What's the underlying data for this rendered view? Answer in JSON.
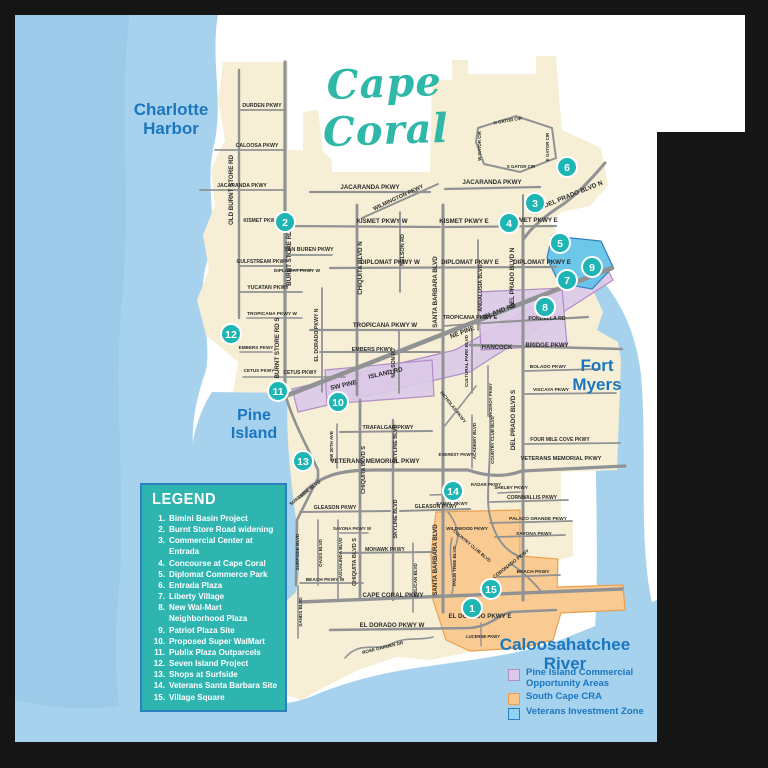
{
  "title": {
    "text": "Cape Coral"
  },
  "water_labels": [
    {
      "id": "charlotte-harbor",
      "text": "Charlotte\nHarbor",
      "x": 171,
      "y": 117,
      "size": 17
    },
    {
      "id": "pine-island",
      "text": "Pine\nIsland",
      "x": 254,
      "y": 423,
      "size": 16
    },
    {
      "id": "fort-myers",
      "text": "Fort\nMyers",
      "x": 597,
      "y": 373,
      "size": 17
    },
    {
      "id": "caloosahatchee-river",
      "text": "Caloosahatchee\nRiver",
      "x": 565,
      "y": 652,
      "size": 17
    }
  ],
  "legend": {
    "title": "LEGEND",
    "items": [
      {
        "num": "1.",
        "label": "Bimini Basin Project"
      },
      {
        "num": "2.",
        "label": "Burnt Store Road widening"
      },
      {
        "num": "3.",
        "label": "Commercial Center at Entrada"
      },
      {
        "num": "4.",
        "label": "Concourse at Cape Coral"
      },
      {
        "num": "5.",
        "label": "Diplomat Commerce Park"
      },
      {
        "num": "6.",
        "label": "Entrada Plaza"
      },
      {
        "num": "7.",
        "label": "Liberty Village"
      },
      {
        "num": "8.",
        "label": "New Wal-Mart\nNeighborhood Plaza"
      },
      {
        "num": "9.",
        "label": "Patriot Plaza Site"
      },
      {
        "num": "10.",
        "label": "Proposed Super WalMart"
      },
      {
        "num": "11.",
        "label": "Publix Plaza Outparcels"
      },
      {
        "num": "12.",
        "label": "Seven Island Project"
      },
      {
        "num": "13.",
        "label": "Shops at Surfside"
      },
      {
        "num": "14.",
        "label": "Veterans Santa Barbara Site"
      },
      {
        "num": "15.",
        "label": "Village Square"
      }
    ]
  },
  "zone_legend": [
    {
      "label": "Pine Island Commercial\nOpportunity Areas",
      "fill": "#dcc9e8",
      "border": "#b28cc6"
    },
    {
      "label": "South Cape CRA",
      "fill": "#f9c78c",
      "border": "#eca04e"
    },
    {
      "label": "Veterans Investment Zone",
      "fill": "#8fd4f2",
      "border": "#2e7fc0"
    }
  ],
  "colors": {
    "marker_teal": "#1db6b4",
    "water": "#a6d2ee",
    "water_deep": "#9bcbe9",
    "land": "#f6efd5",
    "road": "#909294",
    "title_teal": "#2fb8a8",
    "label_blue": "#1b76c0",
    "legend_bg": "#2fb5b0",
    "zone_purple": "#dcc9e8",
    "zone_purple_edge": "#b28cc6",
    "zone_orange": "#f9c78c",
    "zone_orange_edge": "#eca04e",
    "zone_blue": "#5ec2ea",
    "zone_blue_edge": "#2e7fc0"
  },
  "markers": [
    {
      "n": "1",
      "x": 472,
      "y": 608
    },
    {
      "n": "2",
      "x": 285,
      "y": 222
    },
    {
      "n": "3",
      "x": 535,
      "y": 203
    },
    {
      "n": "4",
      "x": 509,
      "y": 223
    },
    {
      "n": "5",
      "x": 560,
      "y": 243
    },
    {
      "n": "6",
      "x": 567,
      "y": 167
    },
    {
      "n": "7",
      "x": 567,
      "y": 280
    },
    {
      "n": "8",
      "x": 545,
      "y": 307
    },
    {
      "n": "9",
      "x": 592,
      "y": 267
    },
    {
      "n": "10",
      "x": 338,
      "y": 402
    },
    {
      "n": "11",
      "x": 278,
      "y": 391
    },
    {
      "n": "12",
      "x": 231,
      "y": 334
    },
    {
      "n": "13",
      "x": 303,
      "y": 461
    },
    {
      "n": "14",
      "x": 453,
      "y": 491
    },
    {
      "n": "15",
      "x": 491,
      "y": 589
    }
  ],
  "road_labels": [
    {
      "t": "OLD BURNT STORE RD",
      "x": 233,
      "y": 190,
      "r": -90
    },
    {
      "t": "BURNT STORE RD N",
      "x": 291,
      "y": 255,
      "r": -90
    },
    {
      "t": "BURNT STORE RD S",
      "x": 279,
      "y": 348,
      "r": -90
    },
    {
      "t": "DURDEN PKWY",
      "x": 262,
      "y": 107,
      "s": 5.2
    },
    {
      "t": "CALOOSA PKWY",
      "x": 257,
      "y": 147,
      "s": 5.2
    },
    {
      "t": "JACARANDA PKWY",
      "x": 242,
      "y": 187,
      "s": 5.2
    },
    {
      "t": "JACARANDA PKWY",
      "x": 370,
      "y": 189
    },
    {
      "t": "JACARANDA PKWY",
      "x": 492,
      "y": 184
    },
    {
      "t": "WILMINGTON PKWY",
      "x": 399,
      "y": 199,
      "r": -25,
      "s": 5.6
    },
    {
      "t": "KISMET PKWY W",
      "x": 264,
      "y": 222,
      "s": 5
    },
    {
      "t": "KISMET PKWY W",
      "x": 382,
      "y": 223
    },
    {
      "t": "KISMET PKWY E",
      "x": 464,
      "y": 223
    },
    {
      "t": "KISMET PKWY E",
      "x": 533,
      "y": 222
    },
    {
      "t": "VAN BUREN PKWY",
      "x": 309,
      "y": 251,
      "s": 5.4
    },
    {
      "t": "GULFSTREAM PKWY",
      "x": 262,
      "y": 263,
      "s": 5
    },
    {
      "t": "DIPLOMAT PKWY W",
      "x": 297,
      "y": 272,
      "s": 4.8
    },
    {
      "t": "DIPLOMAT PKWY W",
      "x": 390,
      "y": 264
    },
    {
      "t": "DIPLOMAT PKWY E",
      "x": 470,
      "y": 264
    },
    {
      "t": "DIPLOMAT PKWY E",
      "x": 542,
      "y": 264
    },
    {
      "t": "YUCATAN PKWY",
      "x": 268,
      "y": 289,
      "s": 5.2
    },
    {
      "t": "TROPICANA PKWY W",
      "x": 272,
      "y": 315,
      "s": 4.8
    },
    {
      "t": "TROPICANA PKWY W",
      "x": 385,
      "y": 327
    },
    {
      "t": "TROPICANA PKWY E",
      "x": 470,
      "y": 319,
      "s": 5.4
    },
    {
      "t": "NELSON RD",
      "x": 404,
      "y": 250,
      "r": -90,
      "s": 5.4
    },
    {
      "t": "NELSON RD",
      "x": 395,
      "y": 363,
      "r": -90,
      "s": 5
    },
    {
      "t": "CHIQUITA BLVD N",
      "x": 362,
      "y": 268,
      "r": -90
    },
    {
      "t": "CHIQUITA BLVD S",
      "x": 365,
      "y": 470,
      "r": -90,
      "s": 5.6
    },
    {
      "t": "CHIQUITA BLVD S",
      "x": 356,
      "y": 562,
      "r": -90,
      "s": 5.6
    },
    {
      "t": "SANTA BARBARA BLVD",
      "x": 437,
      "y": 292,
      "r": -90
    },
    {
      "t": "SANTA BARBARA BLVD",
      "x": 437,
      "y": 560,
      "r": -90
    },
    {
      "t": "ANDALUSIA BLVD",
      "x": 482,
      "y": 288,
      "r": -90,
      "s": 5.4
    },
    {
      "t": "EL DORADO PKWY N",
      "x": 318,
      "y": 335,
      "r": -90,
      "s": 5.2
    },
    {
      "t": "EMBERS PKWY",
      "x": 256,
      "y": 349,
      "s": 4.6
    },
    {
      "t": "EMBERS PKWY",
      "x": 372,
      "y": 351,
      "s": 5.4
    },
    {
      "t": "CETUS PKWY",
      "x": 259,
      "y": 372,
      "s": 4.6
    },
    {
      "t": "CETUS PKWY",
      "x": 300,
      "y": 374,
      "s": 5
    },
    {
      "t": "SW PINE",
      "x": 344,
      "y": 387,
      "r": -13,
      "s": 6.4
    },
    {
      "t": "ISLAND RD",
      "x": 386,
      "y": 375,
      "r": -13,
      "s": 6.4
    },
    {
      "t": "NE PINE",
      "x": 463,
      "y": 334,
      "r": -21,
      "s": 6.4
    },
    {
      "t": "ISLAND RD",
      "x": 500,
      "y": 313,
      "r": -21,
      "s": 6.4
    },
    {
      "t": "HANCOCK",
      "x": 497,
      "y": 349,
      "s": 6
    },
    {
      "t": "BRIDGE PKWY",
      "x": 547,
      "y": 347,
      "s": 6
    },
    {
      "t": "PONDELLA RD",
      "x": 547,
      "y": 320,
      "s": 5.2
    },
    {
      "t": "BOLADO PKWY",
      "x": 548,
      "y": 368,
      "s": 4.8
    },
    {
      "t": "VISCAYA PKWY",
      "x": 551,
      "y": 391,
      "s": 4.8
    },
    {
      "t": "FOUR MILE COVE PKWY",
      "x": 560,
      "y": 441,
      "s": 5
    },
    {
      "t": "VETERANS  MEMORIAL  PKWY",
      "x": 375,
      "y": 463
    },
    {
      "t": "VETERANS MEMORIAL PKWY",
      "x": 561,
      "y": 460,
      "s": 5.6
    },
    {
      "t": "TRAFALGAR PKWY",
      "x": 388,
      "y": 429,
      "s": 5.4
    },
    {
      "t": "SW 20TH AVE",
      "x": 333,
      "y": 446,
      "r": -90,
      "s": 4.6
    },
    {
      "t": "ACADEMY BLVD",
      "x": 476,
      "y": 441,
      "r": -90,
      "s": 4.6
    },
    {
      "t": "COUNTRY CLUB BLVD",
      "x": 494,
      "y": 440,
      "r": -90,
      "s": 4.4
    },
    {
      "t": "COUNTRY CLUB BLVD",
      "x": 471,
      "y": 547,
      "r": 40,
      "s": 4.4
    },
    {
      "t": "CULTURAL PARK BLVD",
      "x": 468,
      "y": 361,
      "r": -90,
      "s": 4.6
    },
    {
      "t": "NICHOLAS PKWY",
      "x": 452,
      "y": 408,
      "r": 52,
      "s": 4.6
    },
    {
      "t": "VICEROY PKWY",
      "x": 492,
      "y": 400,
      "r": -90,
      "s": 4.4
    },
    {
      "t": "DEL PRADO BLVD N",
      "x": 574,
      "y": 196,
      "r": -22,
      "s": 6.4
    },
    {
      "t": "DEL PRADO BLVD N",
      "x": 514,
      "y": 278,
      "r": -90
    },
    {
      "t": "DEL PRADO BLVD S",
      "x": 515,
      "y": 420,
      "r": -90
    },
    {
      "t": "N GATOR CIR",
      "x": 508,
      "y": 122,
      "r": -10,
      "s": 4.4
    },
    {
      "t": "W GATOR CIR",
      "x": 481,
      "y": 146,
      "r": -90,
      "s": 4.4
    },
    {
      "t": "S GATOR CIR",
      "x": 521,
      "y": 168,
      "s": 4.4
    },
    {
      "t": "E GATOR CIR",
      "x": 549,
      "y": 147,
      "r": -90,
      "s": 4.4
    },
    {
      "t": "KAMAL PKWY",
      "x": 452,
      "y": 505,
      "s": 4.6
    },
    {
      "t": "SHELBY PKWY",
      "x": 511,
      "y": 489,
      "s": 4.6
    },
    {
      "t": "RADAR PKWY",
      "x": 486,
      "y": 486,
      "s": 4.4
    },
    {
      "t": "EVEREST PKWY",
      "x": 456,
      "y": 456,
      "s": 4.4
    },
    {
      "t": "CORNWALLIS PKWY",
      "x": 532,
      "y": 499,
      "s": 5
    },
    {
      "t": "PALACO GRANDE PKWY",
      "x": 538,
      "y": 520,
      "s": 4.8
    },
    {
      "t": "SAVONA PKWY",
      "x": 534,
      "y": 535,
      "s": 4.8
    },
    {
      "t": "SAVONA PKWY W",
      "x": 352,
      "y": 530,
      "s": 4.4
    },
    {
      "t": "BEACH PKWY",
      "x": 533,
      "y": 573,
      "s": 4.8
    },
    {
      "t": "BEACH PKWY W",
      "x": 325,
      "y": 581,
      "s": 4.8
    },
    {
      "t": "WILDWOOD PKWY",
      "x": 467,
      "y": 530,
      "s": 4.6
    },
    {
      "t": "CORONADO PKWY",
      "x": 512,
      "y": 565,
      "r": -38,
      "s": 4.8
    },
    {
      "t": "PALM TREE BLVD",
      "x": 456,
      "y": 566,
      "r": -90,
      "s": 4.6
    },
    {
      "t": "PELICAN BLVD",
      "x": 417,
      "y": 580,
      "r": -90,
      "s": 4.6
    },
    {
      "t": "SKYLINE BLVD",
      "x": 397,
      "y": 444,
      "r": -90,
      "s": 5.4
    },
    {
      "t": "SKYLINE BLVD",
      "x": 397,
      "y": 519,
      "r": -90,
      "s": 5.4
    },
    {
      "t": "GLEASON PKWY",
      "x": 335,
      "y": 509,
      "s": 5.2
    },
    {
      "t": "GLEASON PKWY",
      "x": 436,
      "y": 508,
      "s": 5.2
    },
    {
      "t": "MOHAWK PKWY",
      "x": 385,
      "y": 551,
      "s": 5
    },
    {
      "t": "OASIS BLVD",
      "x": 322,
      "y": 553,
      "r": -90,
      "s": 4.6
    },
    {
      "t": "AGUALINDA BLVD",
      "x": 342,
      "y": 558,
      "r": -90,
      "s": 4.6
    },
    {
      "t": "SURFSIDE BLVD",
      "x": 306,
      "y": 494,
      "r": -38,
      "s": 4.8
    },
    {
      "t": "SURFSIDE BLVD",
      "x": 299,
      "y": 552,
      "r": -90,
      "s": 4.6
    },
    {
      "t": "SANDS BLVD",
      "x": 302,
      "y": 612,
      "r": -90,
      "s": 4.6
    },
    {
      "t": "CAPE CORAL PKWY",
      "x": 393,
      "y": 597
    },
    {
      "t": "EL DORADO PKWY W",
      "x": 392,
      "y": 627
    },
    {
      "t": "EL DORADO PKWY E",
      "x": 480,
      "y": 618
    },
    {
      "t": "ROSE GARDEN DR",
      "x": 383,
      "y": 649,
      "r": -14,
      "s": 4.6
    },
    {
      "t": "LUCERNE PKWY",
      "x": 483,
      "y": 638,
      "s": 4.2
    }
  ]
}
